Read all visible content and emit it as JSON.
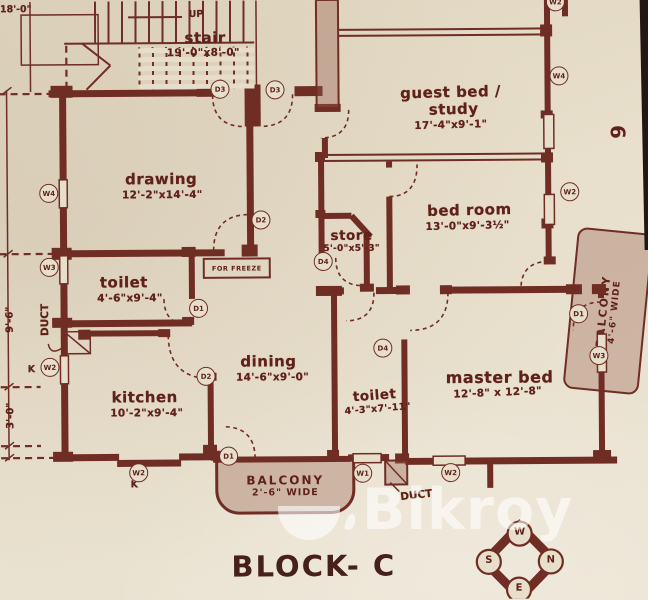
{
  "title": {
    "block": "BLOCK- C",
    "page_number": "6"
  },
  "watermark": {
    "brand": "Bikroy"
  },
  "colors": {
    "ink": "#6f2d24",
    "paper": "#e7dfcc",
    "shade_fill": "#b98e7e",
    "watermark": "#ffffff",
    "title_ink": "#46201a"
  },
  "rooms": {
    "stair": {
      "name": "stair",
      "dims": "19'-0\"x8'-0\""
    },
    "drawing": {
      "name": "drawing",
      "dims": "12'-2\"x14'-4\""
    },
    "guest_bed": {
      "name_line1": "guest bed /",
      "name_line2": "study",
      "dims": "17'-4\"x9'-1\""
    },
    "bed_room": {
      "name": "bed room",
      "dims": "13'-0\"x9'-3½\""
    },
    "store": {
      "name": "store",
      "dims": "5'-0\"x5'-3\""
    },
    "toilet_top": {
      "name": "toilet",
      "dims": "4'-6\"x9'-4\""
    },
    "dining": {
      "name": "dining",
      "dims": "14'-6\"x9'-0\""
    },
    "kitchen": {
      "name": "kitchen",
      "dims": "10'-2\"x9'-4\""
    },
    "toilet_bottom": {
      "name": "toilet",
      "dims": "4'-3\"x7'-11\""
    },
    "master_bed": {
      "name": "master bed",
      "dims": "12'-8\" x 12'-8\""
    }
  },
  "balconies": {
    "bottom": {
      "name": "BALCONY",
      "width_note": "2'-6\" WIDE"
    },
    "right": {
      "name": "BALCONY",
      "width_note": "4'-6\" WIDE"
    }
  },
  "annotations": {
    "up": "UP",
    "for_freeze": "FOR FREEZE",
    "duct_left": "DUCT",
    "duct_bottom": "DUCT",
    "k_left": "K",
    "k_bottom": "K",
    "dim_top_left": "18'-0\"",
    "dim_left_upper": "9'-6\"",
    "dim_left_lower": "3'-0\""
  },
  "compass": {
    "top": "W",
    "right": "N",
    "bottom": "E",
    "left": "S"
  },
  "markers": [
    {
      "label": "W4"
    },
    {
      "label": "W3"
    },
    {
      "label": "W2"
    },
    {
      "label": "D3"
    },
    {
      "label": "D3"
    },
    {
      "label": "D2"
    },
    {
      "label": "D1"
    },
    {
      "label": "D2"
    },
    {
      "label": "D4"
    },
    {
      "label": "D1"
    },
    {
      "label": "W2"
    },
    {
      "label": "W1"
    },
    {
      "label": "W2"
    },
    {
      "label": "W3"
    },
    {
      "label": "W2"
    },
    {
      "label": "W4"
    },
    {
      "label": "W2"
    },
    {
      "label": "D1"
    },
    {
      "label": "D4"
    }
  ]
}
